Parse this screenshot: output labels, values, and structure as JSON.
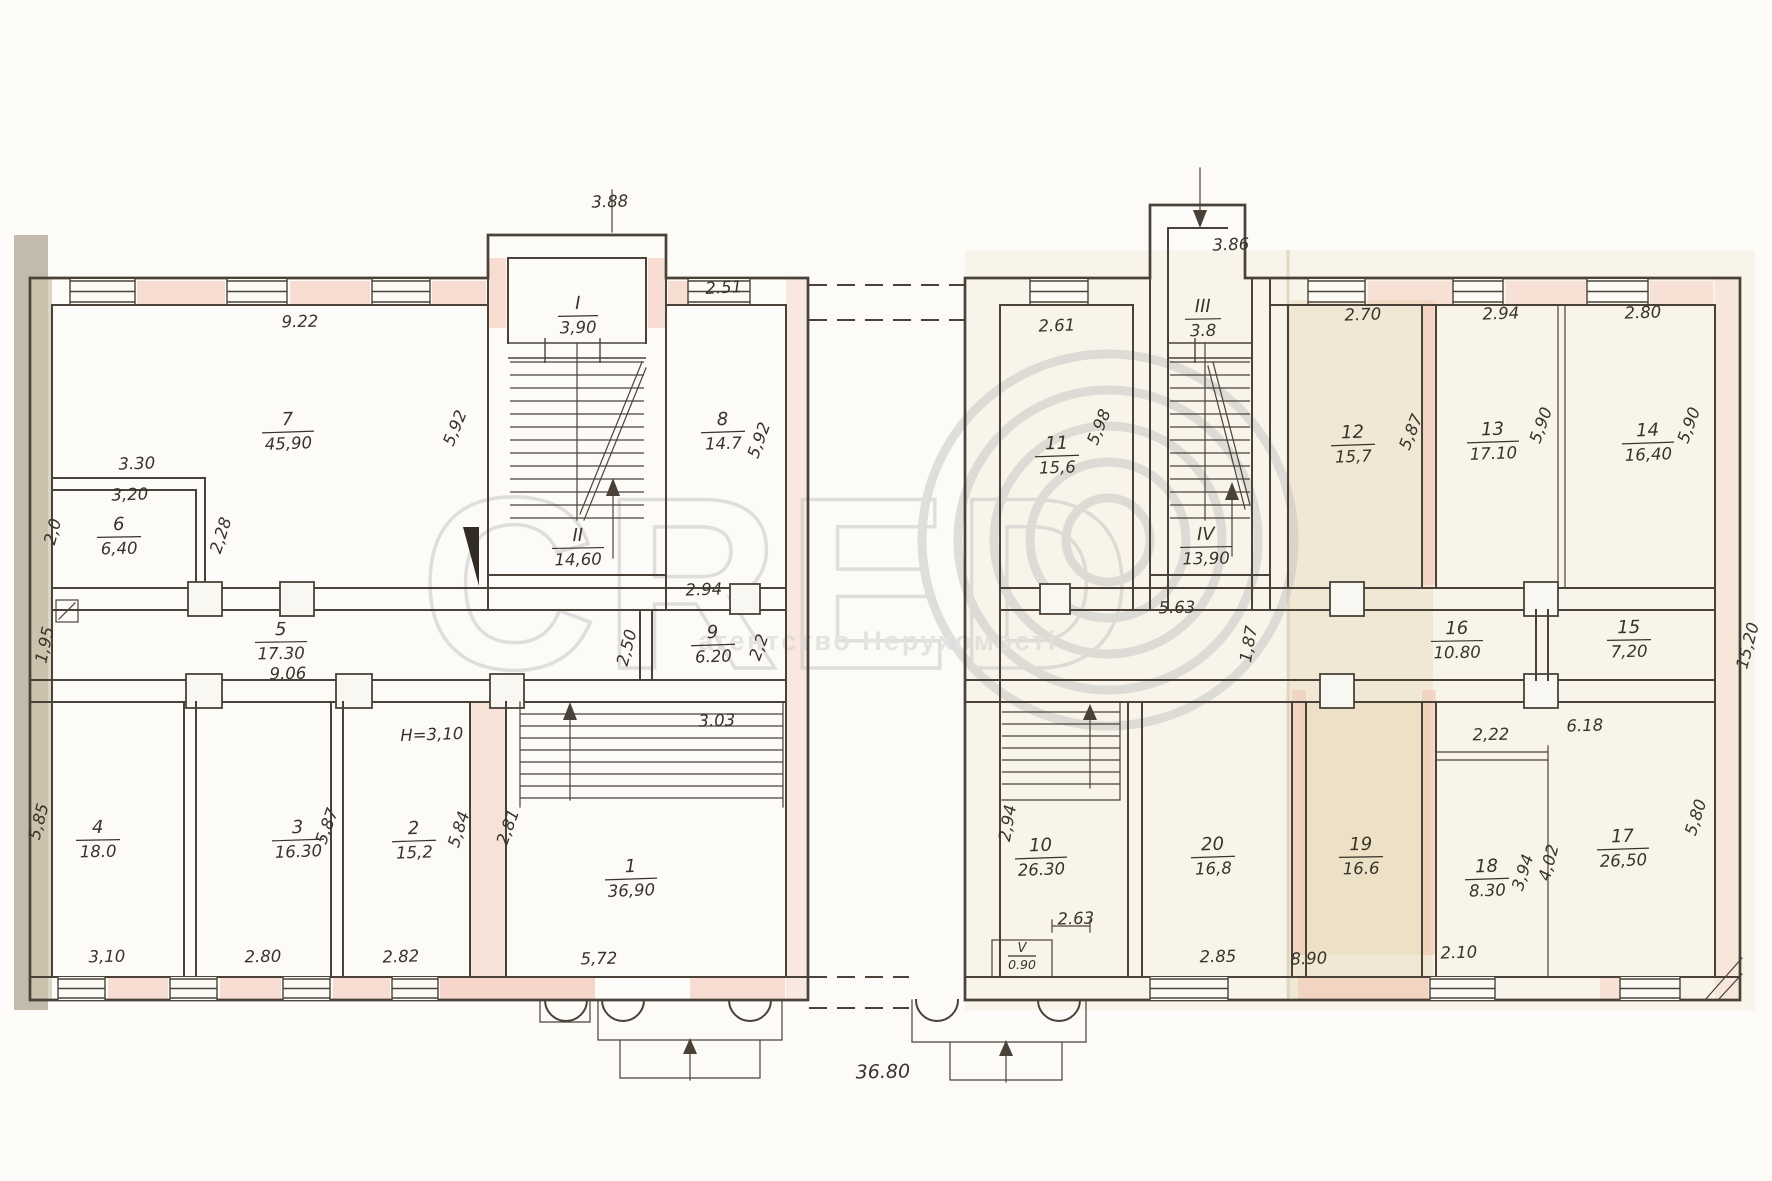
{
  "watermark": {
    "letters": "CRED",
    "logo_icon": "concentric-rings-O",
    "tagline": "агентство Нерухомості"
  },
  "rooms": {
    "1": {
      "num": "1",
      "area": "36,90"
    },
    "2": {
      "num": "2",
      "area": "15,2"
    },
    "3": {
      "num": "3",
      "area": "16.30"
    },
    "4": {
      "num": "4",
      "area": "18.0"
    },
    "5": {
      "num": "5",
      "area": "17.30"
    },
    "6": {
      "num": "6",
      "area": "6,40"
    },
    "7": {
      "num": "7",
      "area": "45,90"
    },
    "8": {
      "num": "8",
      "area": "14.7"
    },
    "9": {
      "num": "9",
      "area": "6.20"
    },
    "10": {
      "num": "10",
      "area": "26.30"
    },
    "11": {
      "num": "11",
      "area": "15,6"
    },
    "12": {
      "num": "12",
      "area": "15,7"
    },
    "13": {
      "num": "13",
      "area": "17.10"
    },
    "14": {
      "num": "14",
      "area": "16,40"
    },
    "15": {
      "num": "15",
      "area": "7,20"
    },
    "16": {
      "num": "16",
      "area": "10.80"
    },
    "17": {
      "num": "17",
      "area": "26,50"
    },
    "18": {
      "num": "18",
      "area": "8.30"
    },
    "19": {
      "num": "19",
      "area": "16.6"
    },
    "20": {
      "num": "20",
      "area": "16,8"
    },
    "I": {
      "num": "I",
      "area": "3,90"
    },
    "II": {
      "num": "II",
      "area": "14,60"
    },
    "III": {
      "num": "III",
      "area": "3.8"
    },
    "IV": {
      "num": "IV",
      "area": "13,90"
    },
    "V": {
      "num": "V",
      "area": "0.90"
    }
  },
  "dims": [
    "9.22",
    "3.88",
    "2.51",
    "5,92",
    "5,92",
    "3.30",
    "3,20",
    "2,0",
    "2,28",
    "1,95",
    "9.06",
    "2.94",
    "2,50",
    "2,2",
    "3.03",
    "5,85",
    "5,87",
    "5,84",
    "2,81",
    "3,10",
    "2.80",
    "2.82",
    "5,72",
    "36.80",
    "3.86",
    "2.61",
    "5,98",
    "2.70",
    "2.94",
    "2.80",
    "5,87",
    "5,90",
    "5,90",
    "5.63",
    "1,87",
    "15,20",
    "2,94",
    "2.63",
    "2.85",
    "8.90",
    "2.10",
    "6.18",
    "2,22",
    "3,94",
    "4,02",
    "H=3,10",
    "5,80"
  ]
}
